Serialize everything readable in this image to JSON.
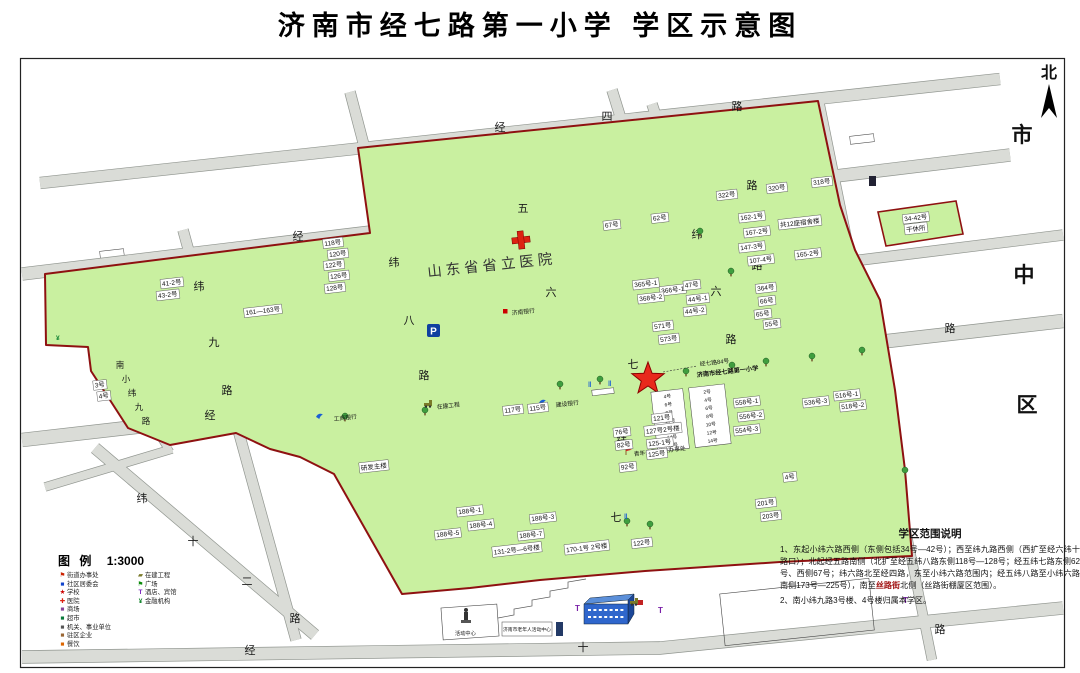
{
  "title": "济南市经七路第一小学 学区示意图",
  "north_label": "北",
  "district_chars": [
    "市",
    "中",
    "区"
  ],
  "hospital": "山东省省立医院",
  "school": {
    "line1": "经七路84号",
    "line2": "济南市经七路第一小学"
  },
  "roads": {
    "jingsi": {
      "name": "经四路",
      "chars": [
        "经",
        "四",
        "路"
      ]
    },
    "jingwu": {
      "name": "经五路",
      "chars": [
        "经",
        "五",
        "路"
      ]
    },
    "jingliu": {
      "name": "经六路",
      "chars": [
        "六",
        "路"
      ]
    },
    "jingqi": {
      "name": "经七路",
      "chars": [
        "经",
        "七",
        "路"
      ]
    },
    "jingshi": {
      "name": "经十路",
      "chars": [
        "经",
        "十",
        "路"
      ]
    },
    "weiliu": {
      "name": "纬六路",
      "chars": [
        "纬",
        "六",
        "路"
      ]
    },
    "weiqi": {
      "name": "纬七路",
      "chars": [
        "纬",
        "七"
      ]
    },
    "weiba": {
      "name": "纬八路",
      "chars": [
        "纬",
        "八",
        "路"
      ]
    },
    "weijiu": {
      "name": "纬九路",
      "chars": [
        "纬",
        "九",
        "路"
      ]
    },
    "weishier": {
      "name": "纬十二路",
      "chars": [
        "纬",
        "十",
        "二",
        "路"
      ]
    },
    "nanxiaoweijiu": {
      "name": "南小纬九路",
      "chars": [
        "南",
        "小",
        "纬",
        "九",
        "路"
      ]
    }
  },
  "labels": [
    "322号",
    "320号",
    "318号",
    "162-1号",
    "167-2号",
    "147-3号",
    "107-4号",
    "165-2号",
    "共12座宿舍楼",
    "34-42号",
    "干休所",
    "364号",
    "66号",
    "65号",
    "55号",
    "365号-1",
    "366号-1",
    "368号-2",
    "47号",
    "44号-1",
    "44号-2",
    "571号",
    "573号",
    "118号",
    "120号",
    "122号",
    "126号",
    "128号",
    "161—163号",
    "41-2号",
    "43-2号",
    "3号",
    "4号",
    "62号",
    "67号",
    "研发主楼",
    "188号-1",
    "188号-4",
    "188号-5",
    "188号-3",
    "188号-7",
    "131-2号—6号楼",
    "170-1号 2号楼",
    "121号",
    "127号2号楼",
    "125-1号",
    "125号",
    "82号",
    "92号",
    "122号",
    "558号-1",
    "556号-2",
    "554号-3",
    "536号-3",
    "516号-1",
    "518号-2",
    "4号",
    "201号",
    "203号",
    "117号",
    "115号",
    "76号"
  ],
  "school_tables": {
    "a": [
      "4号",
      "6号",
      "8号",
      "10号",
      "12号",
      "14号",
      "16号"
    ],
    "b": [
      "2号",
      "4号",
      "6号",
      "8号",
      "10号",
      "12号",
      "14号"
    ]
  },
  "poi": {
    "bank1": "工商银行",
    "bank2": "济南银行",
    "bank3": "建设银行",
    "construction": "在建工程",
    "street_office": "青年公园街道办事处",
    "activity_center": "活动中心",
    "senior_center": "济南市老年人活动中心"
  },
  "legend": {
    "heading": "图  例",
    "scale": "1:3000",
    "left": [
      "街道办事处",
      "社区居委会",
      "学校",
      "医院",
      "商场",
      "超市",
      "机关、事业单位",
      "驻区企业",
      "餐饮"
    ],
    "left_icons": [
      "flag-red-icon",
      "square-blue-icon",
      "star-red-icon",
      "cross-red-icon",
      "square-purple-icon",
      "square-green-icon",
      "square-gray-icon",
      "square-brown-icon",
      "square-orange-icon"
    ],
    "right": [
      "在建工程",
      "广场",
      "酒店、宾馆",
      "金融机构"
    ],
    "right_icons": [
      "bulldozer-icon",
      "flag-green-icon",
      "hotel-t-icon",
      "money-icon"
    ]
  },
  "notes": {
    "heading": "学区范围说明",
    "p1": "1、东起小纬六路西侧（东侧包括34号—42号）；西至纬九路西侧（西扩至经六纬十路口）；北起经五路南侧（北扩至经五纬八路东侧118号—128号；经五纬七路东侧62号、西侧67号；纬六路北至经四路，东至小纬六路范围内；经五纬八路至小纬六路南侧173号—225号），南至",
    "p1_red": "丝路街",
    "p1_end": "北侧（丝路街棚厦区范围）。",
    "p2": "2、南小纬九路3号楼、4号楼归属本学区。"
  },
  "colors": {
    "district_green": "#c9f0a0",
    "road_gray": "#dadcd7",
    "boundary_red": "#8e1111",
    "star_red": "#e8291c"
  }
}
